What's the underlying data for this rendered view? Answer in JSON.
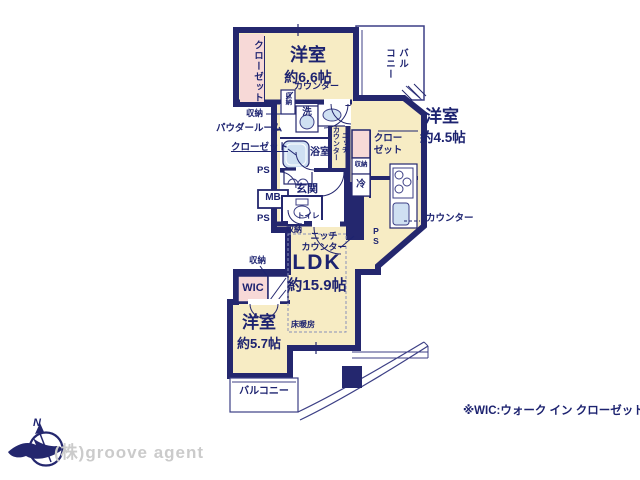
{
  "plan_type": "floorplan",
  "colors": {
    "wall": "#24276e",
    "room_fill": "#f7ecc4",
    "closet_fill": "#f7d9d7",
    "fixture_fill": "#cfe0f2",
    "text": "#1d2370",
    "watermark": "#cbcbcb"
  },
  "rooms": {
    "bedroom66": {
      "name": "洋室",
      "size": "約6.6帖"
    },
    "bedroom45": {
      "name": "洋室",
      "size": "約4.5帖"
    },
    "bedroom57": {
      "name": "洋室",
      "size": "約5.7帖"
    },
    "ldk": {
      "name": "LDK",
      "size": "約15.9帖"
    },
    "wic": "WIC",
    "genkan": "玄関",
    "bath": "浴室",
    "toilet": "トイレ",
    "powder_room": "パウダールーム"
  },
  "labels": {
    "closet": "クローゼット",
    "closet45_l1": "クロー",
    "closet45_l2": "ゼット",
    "counter": "カウンター",
    "niche": "ニッチ",
    "storage": "収納",
    "wash": "洗",
    "fridge": "冷",
    "ps": "PS",
    "mb": "MB",
    "floor_heating": "床暖房",
    "balcony": "バルコニー",
    "balcony_v1": "バル",
    "balcony_v2": "コニー"
  },
  "footer": {
    "wic_note": "※WIC:ウォーク イン クローゼット",
    "watermark": "(株)groove agent",
    "compass_north": "N"
  }
}
